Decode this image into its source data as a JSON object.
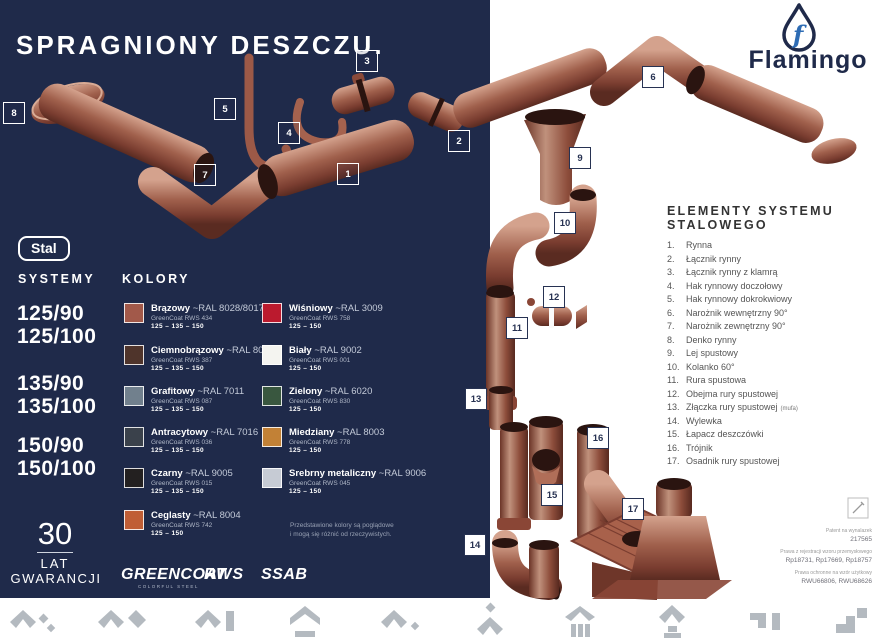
{
  "palette": {
    "navy": "#1f2a4a",
    "copper": "#a0604c",
    "logo_blue": "#2e6cb4",
    "icon_gray": "#b4bac0"
  },
  "left_panel": {
    "title": "SPRAGNIONY DESZCZU.",
    "material_badge": "Stal",
    "systems": {
      "heading": "SYSTEMY",
      "groups": [
        [
          "125/90",
          "125/100"
        ],
        [
          "135/90",
          "135/100"
        ],
        [
          "150/90",
          "150/100"
        ]
      ]
    },
    "colors": {
      "heading": "KOLORY",
      "note_line1": "Przedstawione kolory są poglądowe",
      "note_line2": "i mogą się różnić od rzeczywistych.",
      "items_left": [
        {
          "name": "Brązowy",
          "ral": "~RAL 8028/8017",
          "greencoat": "GreenCoat RWS 434",
          "sizes": "125 – 135 – 150",
          "hex": "#a2594a"
        },
        {
          "name": "Ciemnobrązowy",
          "ral": "~RAL 8019",
          "greencoat": "GreenCoat RWS 387",
          "sizes": "125 – 135 – 150",
          "hex": "#4f342b"
        },
        {
          "name": "Grafitowy",
          "ral": "~RAL 7011",
          "greencoat": "GreenCoat RWS 087",
          "sizes": "125 – 135 – 150",
          "hex": "#71808d"
        },
        {
          "name": "Antracytowy",
          "ral": "~RAL 7016",
          "greencoat": "GreenCoat RWS 036",
          "sizes": "125 – 135 – 150",
          "hex": "#3a414b"
        },
        {
          "name": "Czarny",
          "ral": "~RAL 9005",
          "greencoat": "GreenCoat RWS 015",
          "sizes": "125 – 135 – 150",
          "hex": "#232020"
        },
        {
          "name": "Ceglasty",
          "ral": "~RAL 8004",
          "greencoat": "GreenCoat RWS 742",
          "sizes": "125 – 150",
          "hex": "#c05e36"
        }
      ],
      "items_right": [
        {
          "name": "Wiśniowy",
          "ral": "~RAL 3009",
          "greencoat": "GreenCoat RWS 758",
          "sizes": "125 – 150",
          "hex": "#bb1a2e"
        },
        {
          "name": "Biały",
          "ral": "~RAL 9002",
          "greencoat": "GreenCoat RWS 001",
          "sizes": "125 – 150",
          "hex": "#f4f4f0"
        },
        {
          "name": "Zielony",
          "ral": "~RAL 6020",
          "greencoat": "GreenCoat RWS 830",
          "sizes": "125 – 150",
          "hex": "#39573f"
        },
        {
          "name": "Miedziany",
          "ral": "~RAL 8003",
          "greencoat": "GreenCoat RWS 778",
          "sizes": "125 – 150",
          "hex": "#c28136"
        },
        {
          "name": "Srebrny metaliczny",
          "ral": "~RAL 9006",
          "greencoat": "GreenCoat RWS 045",
          "sizes": "125 – 150",
          "hex": "#c6cbd4"
        }
      ]
    },
    "warranty": {
      "years": "30",
      "line1": "LAT",
      "line2": "GWARANCJI"
    },
    "brand_logos": {
      "greencoat": "GREENCOAT",
      "greencoat_sub": "COLORFUL STEEL",
      "rws": "RWS",
      "ssab": "SSAB"
    }
  },
  "right_panel": {
    "logo_text": "Flamingo",
    "elements": {
      "heading": "ELEMENTY SYSTEMU STALOWEGO",
      "items": [
        {
          "num": "1.",
          "label": "Rynna"
        },
        {
          "num": "2.",
          "label": "Łącznik rynny"
        },
        {
          "num": "3.",
          "label": "Łącznik rynny z klamrą"
        },
        {
          "num": "4.",
          "label": "Hak rynnowy doczołowy"
        },
        {
          "num": "5.",
          "label": "Hak rynnowy dokrokwiowy"
        },
        {
          "num": "6.",
          "label": "Narożnik wewnętrzny 90°"
        },
        {
          "num": "7.",
          "label": "Narożnik zewnętrzny 90°"
        },
        {
          "num": "8.",
          "label": "Denko rynny"
        },
        {
          "num": "9.",
          "label": "Lej spustowy"
        },
        {
          "num": "10.",
          "label": "Kolanko 60°"
        },
        {
          "num": "11.",
          "label": "Rura spustowa"
        },
        {
          "num": "12.",
          "label": "Obejma rury spustowej"
        },
        {
          "num": "13.",
          "label": "Złączka rury spustowej",
          "suffix": "(mufa)"
        },
        {
          "num": "14.",
          "label": "Wylewka"
        },
        {
          "num": "15.",
          "label": "Łapacz deszczówki"
        },
        {
          "num": "16.",
          "label": "Trójnik"
        },
        {
          "num": "17.",
          "label": "Osadnik rury spustowej"
        }
      ]
    },
    "legal": {
      "l1": "Patent na wynalazek",
      "v1": "217565",
      "l2": "Prawa z rejestracji wzoru przemysłowego",
      "v2": "Rp18731, Rp17669, Rp18757",
      "l3": "Prawa ochronne na wzór użytkowy",
      "v3": "RWU66806, RWU68626"
    }
  },
  "diagram": {
    "badges": [
      "1",
      "2",
      "3",
      "4",
      "5",
      "6",
      "7",
      "8",
      "9",
      "10",
      "11",
      "12",
      "13",
      "14",
      "15",
      "16",
      "17"
    ]
  },
  "footer_icons": [
    "corner-elements-icon",
    "gutter-angle-icon",
    "gutter-bracket-icon",
    "eave-bar-icon",
    "gutter-dot-icon",
    "downspout-person-icon",
    "house-columns-icon",
    "roof-chimney-icon",
    "corner-profile-icon",
    "step-profile-icon"
  ]
}
